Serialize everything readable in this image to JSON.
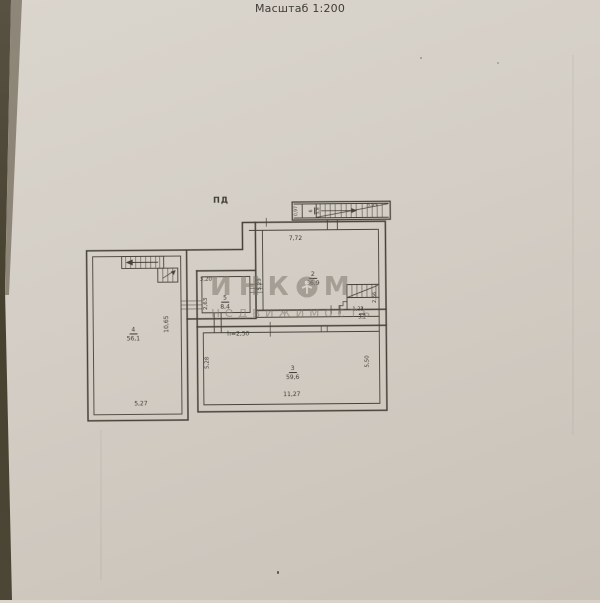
{
  "header": {
    "scale_label": "Масштаб 1:200",
    "plan_code": "ПД"
  },
  "watermark": {
    "brand_prefix": "ИНК",
    "brand_suffix": "М",
    "subtitle": "недвижимость"
  },
  "rooms": {
    "r1": {
      "number": "1",
      "area": "3,2",
      "dim_bottom": "1,23",
      "dim_right": "2,66"
    },
    "r2": {
      "number": "2",
      "area": "36,9",
      "dim_top": "7,72",
      "dim_left": "5,29"
    },
    "r3": {
      "number": "3",
      "area": "59,6",
      "dim_left": "5,28",
      "dim_right": "5,50",
      "dim_bottom": "11,27",
      "height_note": "h=2,50"
    },
    "r4": {
      "number": "4",
      "area": "56,1",
      "dim_right": "10,65",
      "dim_bottom": "5,27"
    },
    "r5": {
      "number": "5",
      "area": "8,4",
      "dim_top": "3,20",
      "dim_left": "2,63"
    },
    "r6": {
      "number": "6",
      "area": "5,8",
      "dim_width": "0,97",
      "dim_length": "5,95"
    }
  },
  "colors": {
    "paper": "#d3cdc5",
    "ink": "#3b3833",
    "watermark": "#7b756a"
  }
}
